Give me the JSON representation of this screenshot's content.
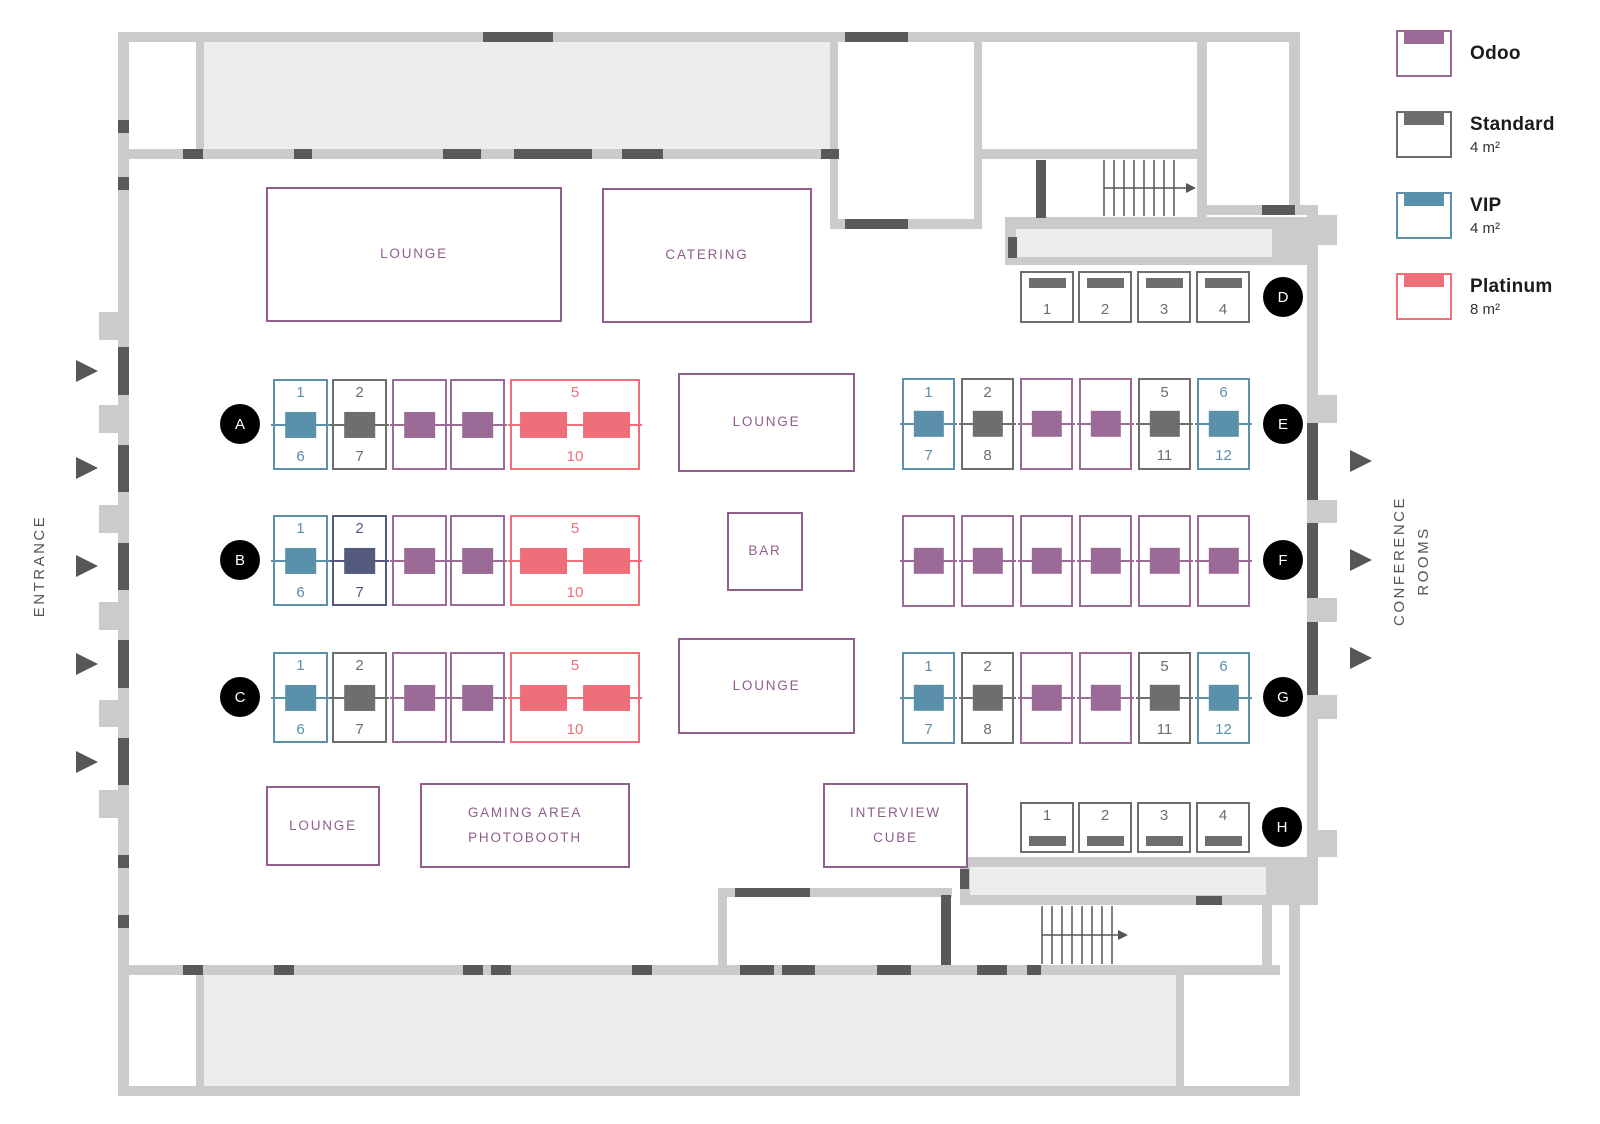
{
  "labels": {
    "entrance": "ENTRANCE",
    "conference_line1": "CONFERENCE",
    "conference_line2": "ROOMS"
  },
  "legend": {
    "items": [
      {
        "name": "Odoo",
        "size": "",
        "color": "#9b6a97"
      },
      {
        "name": "Standard",
        "size": "4 m²",
        "color": "#6e6e6e"
      },
      {
        "name": "VIP",
        "size": "4 m²",
        "color": "#5a90a9"
      },
      {
        "name": "Platinum",
        "size": "8 m²",
        "color": "#ee6e79"
      }
    ]
  },
  "booth_types": {
    "odoo": {
      "color": "#9b6a97"
    },
    "standard": {
      "color": "#6e6e6e"
    },
    "vip": {
      "color": "#5a90a9"
    },
    "platinum": {
      "color": "#ee6e79"
    },
    "dark": {
      "color": "#545a7d"
    }
  },
  "areas": [
    {
      "id": "lounge-top",
      "lines": [
        "LOUNGE"
      ],
      "x": 266,
      "y": 187,
      "w": 296,
      "h": 135
    },
    {
      "id": "catering",
      "lines": [
        "CATERING"
      ],
      "x": 602,
      "y": 188,
      "w": 210,
      "h": 135
    },
    {
      "id": "lounge-mid",
      "lines": [
        "LOUNGE"
      ],
      "x": 678,
      "y": 373,
      "w": 177,
      "h": 99
    },
    {
      "id": "bar",
      "lines": [
        "BAR"
      ],
      "x": 727,
      "y": 512,
      "w": 76,
      "h": 79
    },
    {
      "id": "lounge-low",
      "lines": [
        "LOUNGE"
      ],
      "x": 678,
      "y": 638,
      "w": 177,
      "h": 96
    },
    {
      "id": "lounge-bottom",
      "lines": [
        "LOUNGE"
      ],
      "x": 266,
      "y": 786,
      "w": 114,
      "h": 80
    },
    {
      "id": "gaming-photobooth",
      "lines": [
        "GAMING AREA",
        "PHOTOBOOTH"
      ],
      "x": 420,
      "y": 783,
      "w": 210,
      "h": 85
    },
    {
      "id": "interview-cube",
      "lines": [
        "INTERVIEW",
        "CUBE"
      ],
      "x": 823,
      "y": 783,
      "w": 145,
      "h": 85
    }
  ],
  "rows": [
    {
      "id": "A",
      "kind": "v",
      "y": 379,
      "h": 91,
      "badge": {
        "x": 240,
        "y": 424
      },
      "booths": [
        {
          "type": "vip",
          "x": 273,
          "w": 55,
          "top": "1",
          "bottom": "6"
        },
        {
          "type": "standard",
          "x": 332,
          "w": 55,
          "top": "2",
          "bottom": "7"
        },
        {
          "type": "odoo",
          "x": 392,
          "w": 55
        },
        {
          "type": "odoo",
          "x": 450,
          "w": 55
        },
        {
          "type": "platinum",
          "x": 510,
          "w": 130,
          "top": "5",
          "bottom": "10",
          "desks": 2
        }
      ]
    },
    {
      "id": "B",
      "kind": "v",
      "y": 515,
      "h": 91,
      "badge": {
        "x": 240,
        "y": 560
      },
      "booths": [
        {
          "type": "vip",
          "x": 273,
          "w": 55,
          "top": "1",
          "bottom": "6"
        },
        {
          "type": "dark",
          "x": 332,
          "w": 55,
          "top": "2",
          "bottom": "7"
        },
        {
          "type": "odoo",
          "x": 392,
          "w": 55
        },
        {
          "type": "odoo",
          "x": 450,
          "w": 55
        },
        {
          "type": "platinum",
          "x": 510,
          "w": 130,
          "top": "5",
          "bottom": "10",
          "desks": 2
        }
      ]
    },
    {
      "id": "C",
      "kind": "v",
      "y": 652,
      "h": 91,
      "badge": {
        "x": 240,
        "y": 697
      },
      "booths": [
        {
          "type": "vip",
          "x": 273,
          "w": 55,
          "top": "1",
          "bottom": "6"
        },
        {
          "type": "standard",
          "x": 332,
          "w": 55,
          "top": "2",
          "bottom": "7"
        },
        {
          "type": "odoo",
          "x": 392,
          "w": 55
        },
        {
          "type": "odoo",
          "x": 450,
          "w": 55
        },
        {
          "type": "platinum",
          "x": 510,
          "w": 130,
          "top": "5",
          "bottom": "10",
          "desks": 2
        }
      ]
    },
    {
      "id": "D",
      "kind": "top",
      "y": 271,
      "h": 52,
      "badge": {
        "x": 1283,
        "y": 297
      },
      "booths": [
        {
          "type": "standard",
          "x": 1020,
          "w": 54,
          "num": "1"
        },
        {
          "type": "standard",
          "x": 1078,
          "w": 54,
          "num": "2"
        },
        {
          "type": "standard",
          "x": 1137,
          "w": 54,
          "num": "3"
        },
        {
          "type": "standard",
          "x": 1196,
          "w": 54,
          "num": "4"
        }
      ]
    },
    {
      "id": "E",
      "kind": "v",
      "y": 378,
      "h": 92,
      "badge": {
        "x": 1283,
        "y": 424
      },
      "booths": [
        {
          "type": "vip",
          "x": 902,
          "w": 53,
          "top": "1",
          "bottom": "7"
        },
        {
          "type": "standard",
          "x": 961,
          "w": 53,
          "top": "2",
          "bottom": "8"
        },
        {
          "type": "odoo",
          "x": 1020,
          "w": 53
        },
        {
          "type": "odoo",
          "x": 1079,
          "w": 53
        },
        {
          "type": "standard",
          "x": 1138,
          "w": 53,
          "top": "5",
          "bottom": "11"
        },
        {
          "type": "vip",
          "x": 1197,
          "w": 53,
          "top": "6",
          "bottom": "12"
        }
      ]
    },
    {
      "id": "F",
      "kind": "v",
      "y": 515,
      "h": 92,
      "badge": {
        "x": 1283,
        "y": 560
      },
      "booths": [
        {
          "type": "odoo",
          "x": 902,
          "w": 53
        },
        {
          "type": "odoo",
          "x": 961,
          "w": 53
        },
        {
          "type": "odoo",
          "x": 1020,
          "w": 53
        },
        {
          "type": "odoo",
          "x": 1079,
          "w": 53
        },
        {
          "type": "odoo",
          "x": 1138,
          "w": 53
        },
        {
          "type": "odoo",
          "x": 1197,
          "w": 53
        }
      ]
    },
    {
      "id": "G",
      "kind": "v",
      "y": 652,
      "h": 92,
      "badge": {
        "x": 1283,
        "y": 697
      },
      "booths": [
        {
          "type": "vip",
          "x": 902,
          "w": 53,
          "top": "1",
          "bottom": "7"
        },
        {
          "type": "standard",
          "x": 961,
          "w": 53,
          "top": "2",
          "bottom": "8"
        },
        {
          "type": "odoo",
          "x": 1020,
          "w": 53
        },
        {
          "type": "odoo",
          "x": 1079,
          "w": 53
        },
        {
          "type": "standard",
          "x": 1138,
          "w": 53,
          "top": "5",
          "bottom": "11"
        },
        {
          "type": "vip",
          "x": 1197,
          "w": 53,
          "top": "6",
          "bottom": "12"
        }
      ]
    },
    {
      "id": "H",
      "kind": "bottom",
      "y": 802,
      "h": 51,
      "badge": {
        "x": 1282,
        "y": 827
      },
      "booths": [
        {
          "type": "standard",
          "x": 1020,
          "w": 54,
          "num": "1"
        },
        {
          "type": "standard",
          "x": 1078,
          "w": 54,
          "num": "2"
        },
        {
          "type": "standard",
          "x": 1137,
          "w": 54,
          "num": "3"
        },
        {
          "type": "standard",
          "x": 1196,
          "w": 54,
          "num": "4"
        }
      ]
    }
  ]
}
